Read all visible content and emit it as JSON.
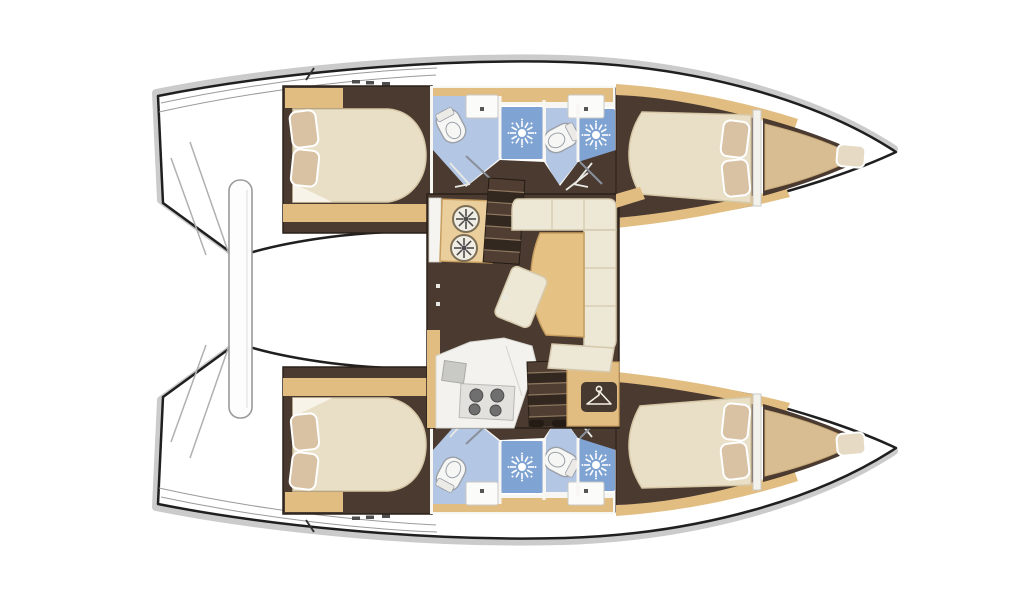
{
  "diagram": {
    "type": "floorplan",
    "vessel": "sailing catamaran",
    "view": "overhead interior deck plan, stern at left, twin bows at right",
    "hulls": [
      {
        "name": "port hull (top)",
        "rooms": [
          "aft double cabin with two pillows",
          "head with toilet and washbasin",
          "separate shower stall",
          "second head with toilet and washbasin",
          "second shower stall",
          "forward double cabin with two pillows",
          "forepeak berth with pillow"
        ],
        "exterior": [
          "transom steps",
          "deck cleats",
          "bow point"
        ]
      },
      {
        "name": "starboard hull (bottom)",
        "rooms": [
          "aft double cabin with two pillows",
          "head with toilet and washbasin",
          "separate shower stall",
          "second head with toilet and washbasin",
          "second shower stall",
          "forward double cabin with two pillows",
          "forepeak berth with pillow"
        ],
        "exterior": [
          "transom steps",
          "deck cleats",
          "bow point"
        ]
      }
    ],
    "saloon": {
      "features": [
        "chart table with twin instrument dials",
        "companionway stairs down to port hull",
        "L-shaped settee",
        "curved dining table",
        "rotated ottoman seat",
        "galley counter with sink",
        "four-burner stove",
        "companionway stairs down to starboard hull",
        "hanging wardrobe locker"
      ]
    },
    "between_hulls": [
      "aft crossbeam / davit bar"
    ],
    "counts": {
      "cabins": 4,
      "heads": 4,
      "showers": 4,
      "forepeak_berths": 2
    },
    "colors": {
      "outline": "#1f1f1f",
      "shadow": "#c2c2c2",
      "floor": "#4a3a30",
      "wood": "#e2bd82",
      "wood_dark": "#c79e5f",
      "wood_light": "#eacf9c",
      "bed": "#e9dfc6",
      "bed_stroke": "#d6c7a6",
      "pillow": "#d9c2a4",
      "sofa": "#ede7d6",
      "sofa_stroke": "#d5c9ad",
      "table": "#e5c184",
      "bath_floor": "#b3c7e4",
      "shower": "#7fa3d2",
      "fixture": "#f6f6f4",
      "fixture_stroke": "#9aa0a8",
      "counter": "#f3f2ee",
      "stove_panel": "#e2e1dd",
      "burner": "#6f6f6f",
      "stair_dark": "#33281f",
      "stair_mid": "#4f3e31",
      "stair_edge": "#8f7860",
      "hanger_bg": "#463930",
      "deck_line": "#9a9a9a",
      "berth": "#d8bd92",
      "paper": "#ffffff"
    }
  }
}
